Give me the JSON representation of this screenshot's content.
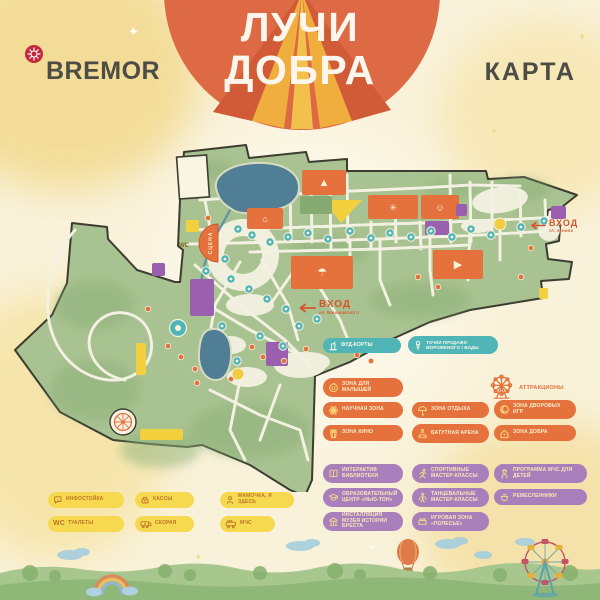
{
  "header": {
    "brand": "BREMOR",
    "title_line1": "ЛУЧИ",
    "title_line2": "ДОБРА",
    "map_label": "КАРТА"
  },
  "map": {
    "stage_label": "СЦЕНА",
    "wc_label": "WC",
    "entrances": [
      {
        "label": "ВХОД",
        "sublabel": "УЛ. ЛЕНИНА"
      },
      {
        "label": "ВХОД",
        "sublabel": "УЛ. ЛЕВАНЕВСКОГО"
      }
    ],
    "zones": [
      {
        "x": 302,
        "y": 40,
        "w": 44,
        "h": 25,
        "c": "o",
        "g": "▲"
      },
      {
        "x": 247,
        "y": 78,
        "w": 36,
        "h": 21,
        "c": "o",
        "g": "⌂"
      },
      {
        "x": 368,
        "y": 65,
        "w": 50,
        "h": 24,
        "c": "o",
        "g": "✳"
      },
      {
        "x": 421,
        "y": 65,
        "w": 38,
        "h": 24,
        "c": "o",
        "g": "☺"
      },
      {
        "x": 433,
        "y": 120,
        "w": 50,
        "h": 29,
        "c": "o",
        "g": "▶"
      },
      {
        "x": 291,
        "y": 126,
        "w": 62,
        "h": 33,
        "c": "o",
        "g": "☂"
      },
      {
        "x": 190,
        "y": 149,
        "w": 24,
        "h": 37,
        "c": "p"
      },
      {
        "x": 425,
        "y": 91,
        "w": 24,
        "h": 14,
        "c": "p"
      },
      {
        "x": 456,
        "y": 74,
        "w": 11,
        "h": 12,
        "c": "p"
      },
      {
        "x": 551,
        "y": 76,
        "w": 15,
        "h": 13,
        "c": "p"
      },
      {
        "x": 266,
        "y": 212,
        "w": 22,
        "h": 24,
        "c": "p"
      },
      {
        "x": 152,
        "y": 133,
        "w": 13,
        "h": 13,
        "c": "p"
      },
      {
        "x": 140,
        "y": 299,
        "w": 43,
        "h": 11,
        "c": "y"
      },
      {
        "x": 136,
        "y": 213,
        "w": 10,
        "h": 32,
        "c": "y"
      },
      {
        "x": 186,
        "y": 90,
        "w": 13,
        "h": 12,
        "c": "y"
      },
      {
        "x": 539,
        "y": 158,
        "w": 9,
        "h": 11,
        "c": "y"
      },
      {
        "x": 300,
        "y": 66,
        "w": 32,
        "h": 18,
        "c": "f"
      }
    ],
    "markers": [
      {
        "x": 238,
        "y": 99,
        "t": "f"
      },
      {
        "x": 252,
        "y": 105,
        "t": "f"
      },
      {
        "x": 270,
        "y": 112,
        "t": "f"
      },
      {
        "x": 288,
        "y": 107,
        "t": "f"
      },
      {
        "x": 308,
        "y": 103,
        "t": "f"
      },
      {
        "x": 328,
        "y": 109,
        "t": "f"
      },
      {
        "x": 350,
        "y": 101,
        "t": "f"
      },
      {
        "x": 371,
        "y": 108,
        "t": "f"
      },
      {
        "x": 390,
        "y": 103,
        "t": "f"
      },
      {
        "x": 411,
        "y": 107,
        "t": "f"
      },
      {
        "x": 431,
        "y": 101,
        "t": "f"
      },
      {
        "x": 452,
        "y": 107,
        "t": "f"
      },
      {
        "x": 471,
        "y": 99,
        "t": "f"
      },
      {
        "x": 491,
        "y": 105,
        "t": "f"
      },
      {
        "x": 521,
        "y": 97,
        "t": "f"
      },
      {
        "x": 544,
        "y": 91,
        "t": "f"
      },
      {
        "x": 225,
        "y": 129,
        "t": "f"
      },
      {
        "x": 206,
        "y": 141,
        "t": "f"
      },
      {
        "x": 231,
        "y": 149,
        "t": "f"
      },
      {
        "x": 249,
        "y": 159,
        "t": "f"
      },
      {
        "x": 267,
        "y": 169,
        "t": "f"
      },
      {
        "x": 286,
        "y": 179,
        "t": "f"
      },
      {
        "x": 299,
        "y": 196,
        "t": "f"
      },
      {
        "x": 317,
        "y": 189,
        "t": "f"
      },
      {
        "x": 260,
        "y": 206,
        "t": "f"
      },
      {
        "x": 283,
        "y": 216,
        "t": "f"
      },
      {
        "x": 237,
        "y": 231,
        "t": "f"
      },
      {
        "x": 222,
        "y": 196,
        "t": "f"
      },
      {
        "x": 208,
        "y": 88,
        "t": "p"
      },
      {
        "x": 531,
        "y": 118,
        "t": "p"
      },
      {
        "x": 148,
        "y": 179,
        "t": "p"
      },
      {
        "x": 168,
        "y": 216,
        "t": "p"
      },
      {
        "x": 181,
        "y": 227,
        "t": "p"
      },
      {
        "x": 195,
        "y": 239,
        "t": "p"
      },
      {
        "x": 252,
        "y": 217,
        "t": "p"
      },
      {
        "x": 263,
        "y": 227,
        "t": "p"
      },
      {
        "x": 284,
        "y": 231,
        "t": "p"
      },
      {
        "x": 231,
        "y": 249,
        "t": "p"
      },
      {
        "x": 306,
        "y": 219,
        "t": "p"
      },
      {
        "x": 340,
        "y": 213,
        "t": "p"
      },
      {
        "x": 357,
        "y": 225,
        "t": "p"
      },
      {
        "x": 371,
        "y": 231,
        "t": "p"
      },
      {
        "x": 418,
        "y": 147,
        "t": "p"
      },
      {
        "x": 438,
        "y": 157,
        "t": "p"
      },
      {
        "x": 521,
        "y": 147,
        "t": "p"
      },
      {
        "x": 197,
        "y": 253,
        "t": "p"
      },
      {
        "x": 500,
        "y": 94,
        "t": "i"
      },
      {
        "x": 238,
        "y": 244,
        "t": "i"
      },
      {
        "x": 178,
        "y": 198,
        "t": "d"
      }
    ]
  },
  "legend": {
    "food": [
      {
        "label": "ФУД-КОРТЫ",
        "icon": "food-court-icon"
      },
      {
        "label": "ТОЧКИ ПРОДАЖИ МОРОЖЕНОГО / ВОДЫ",
        "icon": "ice-cream-icon"
      }
    ],
    "zones": [
      {
        "label": "ЗОНА ДЛЯ МАЛЫШЕЙ",
        "icon": "baby-icon"
      },
      {
        "label": "НАУЧНАЯ ЗОНА",
        "icon": "atom-icon"
      },
      {
        "label": "ЗОНА ОТДЫХА",
        "icon": "umbrella-icon"
      },
      {
        "label": "ЗОНА ДВОРОВЫХ ИГР",
        "icon": "ball-icon"
      },
      {
        "label": "ЗОНА КИНО",
        "icon": "popcorn-icon"
      },
      {
        "label": "БАТУТНАЯ АРЕНА",
        "icon": "trampoline-icon"
      },
      {
        "label": "ЗОНА ДОБРА",
        "icon": "house-heart-icon"
      }
    ],
    "attraction": {
      "label": "АТТРАКЦИОНЫ",
      "icon": "ferris-wheel-icon"
    },
    "activities": [
      {
        "label": "ИНТЕРАКТИВ БИБЛИОТЕКИ",
        "icon": "book-icon"
      },
      {
        "label": "СПОРТИВНЫЕ МАСТЕР-КЛАССЫ",
        "icon": "runner-icon"
      },
      {
        "label": "ПРОГРАММА МЧС ДЛЯ ДЕТЕЙ",
        "icon": "firefighter-icon"
      },
      {
        "label": "ОБРАЗОВАТЕЛЬНЫЙ ЦЕНТР «НЬЮ-ТОН»",
        "icon": "education-icon"
      },
      {
        "label": "ТАНЦЕВАЛЬНЫЕ МАСТЕР-КЛАССЫ",
        "icon": "dancer-icon"
      },
      {
        "label": "РЕМЕСЛЕННИКИ",
        "icon": "pottery-icon"
      },
      {
        "label": "ИНСТАЛЛЯЦИЯ МУЗЕЯ ИСТОРИИ БРЕСТА",
        "icon": "museum-icon"
      },
      {
        "label": "ИГРОВАЯ ЗОНА «ПОЛЕСЬЕ»",
        "icon": "toy-brick-icon"
      }
    ],
    "services": [
      {
        "label": "ИНФОСТОЙКА",
        "icon": "info-icon"
      },
      {
        "label": "КАССЫ",
        "icon": "cash-desk-icon"
      },
      {
        "label": "МАМОЧКА, Я ЗДЕСЬ",
        "icon": "lost-child-icon"
      },
      {
        "label": "ТУАЛЕТЫ",
        "icon": "wc-icon",
        "icon_text": "WC"
      },
      {
        "label": "СКОРАЯ",
        "icon": "ambulance-icon"
      },
      {
        "label": "МЧС",
        "icon": "fire-truck-icon"
      }
    ]
  },
  "colors": {
    "orange": "#e5713d",
    "purple": "#9a5fae",
    "teal": "#4fb5b6",
    "yellow": "#f2d03e",
    "field": "#86ab72",
    "park": "#a9c291",
    "pond": "#507e95",
    "accent": "#d6542c",
    "text_dark": "#4c4c46"
  }
}
